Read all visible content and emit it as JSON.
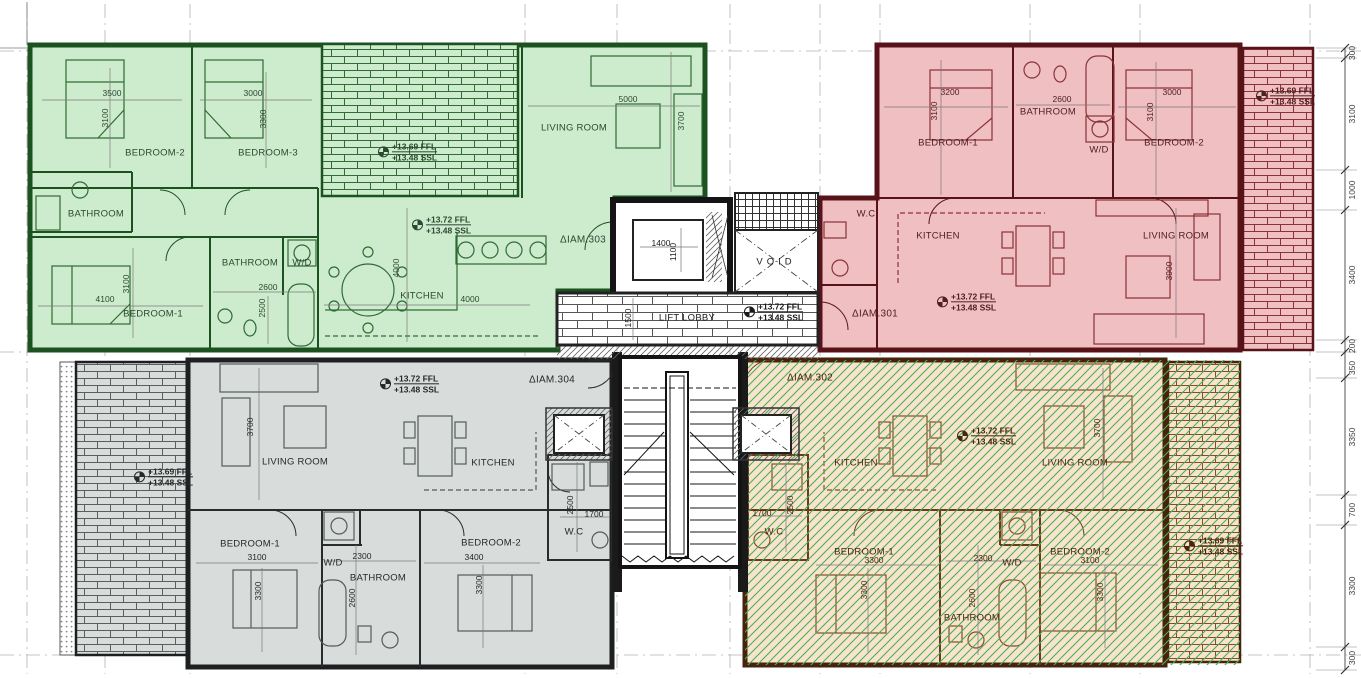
{
  "core": {
    "lift": {
      "width": "1400",
      "depth": "1100"
    },
    "void_label": "VOID",
    "lobby_label": "LIFT LOBBY",
    "lobby_depth": "1500",
    "level": {
      "ffl": "+13.72 FFL",
      "ssl": "+13.48 SSL"
    }
  },
  "apartments": {
    "apt303": {
      "id": "ΔIAM.303",
      "level": {
        "ffl": "+13.72 FFL",
        "ssl": "+13.48 SSL"
      },
      "balcony_level": {
        "ffl": "+13.69 FFL",
        "ssl": "+13.48 SSL"
      },
      "rooms": {
        "bedroom2": {
          "label": "BEDROOM-2",
          "w": "3500",
          "h": "3100"
        },
        "bedroom3": {
          "label": "BEDROOM-3",
          "w": "3000",
          "h": "3300"
        },
        "bathroom_top": {
          "label": "BATHROOM"
        },
        "living": {
          "label": "LIVING ROOM",
          "w": "5000",
          "h": "3700"
        },
        "kitchen": {
          "label": "KITCHEN",
          "w": "4000",
          "h": "4000"
        },
        "bedroom1": {
          "label": "BEDROOM-1",
          "w": "4100",
          "h": "3100"
        },
        "bathroom": {
          "label": "BATHROOM",
          "w": "2600",
          "h": "2500"
        },
        "wd": {
          "label": "W/D"
        }
      }
    },
    "apt301": {
      "id": "ΔIAM.301",
      "level": {
        "ffl": "+13.72 FFL",
        "ssl": "+13.48 SSL"
      },
      "balcony_level": {
        "ffl": "+13.69 FFL",
        "ssl": "+13.48 SSL"
      },
      "rooms": {
        "bedroom1": {
          "label": "BEDROOM-1",
          "w": "3200",
          "h": "3100"
        },
        "bathroom": {
          "label": "BATHROOM",
          "w": "2600"
        },
        "wd": {
          "label": "W/D"
        },
        "bedroom2": {
          "label": "BEDROOM-2",
          "w": "3000",
          "h": "3100"
        },
        "wc": {
          "label": "W.C"
        },
        "kitchen": {
          "label": "KITCHEN"
        },
        "living": {
          "label": "LIVING ROOM",
          "h": "3900"
        }
      }
    },
    "apt304": {
      "id": "ΔIAM.304",
      "level": {
        "ffl": "+13.72 FFL",
        "ssl": "+13.48 SSL"
      },
      "balcony_level": {
        "ffl": "+13.69 FFL",
        "ssl": "+13.48 SSL"
      },
      "rooms": {
        "living": {
          "label": "LIVING ROOM",
          "h": "3700"
        },
        "kitchen": {
          "label": "KITCHEN"
        },
        "wc": {
          "label": "W.C",
          "w": "1700",
          "h": "2500"
        },
        "bedroom1": {
          "label": "BEDROOM-1",
          "w": "3100",
          "h": "3300"
        },
        "wd": {
          "label": "W/D",
          "w": "2300"
        },
        "bathroom": {
          "label": "BATHROOM",
          "h": "2600"
        },
        "bedroom2": {
          "label": "BEDROOM-2",
          "w": "3400",
          "h": "3300"
        }
      }
    },
    "apt302": {
      "id": "ΔIAM.302",
      "level": {
        "ffl": "+13.72 FFL",
        "ssl": "+13.48 SSL"
      },
      "balcony_level": {
        "ffl": "+13.69 FFL",
        "ssl": "+13.48 SSL"
      },
      "rooms": {
        "kitchen": {
          "label": "KITCHEN"
        },
        "living": {
          "label": "LIVING ROOM",
          "h": "3700"
        },
        "wc": {
          "label": "W.C",
          "w": "1700",
          "h": "2500"
        },
        "bedroom1": {
          "label": "BEDROOM-1",
          "w": "3300",
          "h": "3300"
        },
        "wd": {
          "label": "W/D",
          "w": "2300"
        },
        "bathroom": {
          "label": "BATHROOM",
          "h": "2600"
        },
        "bedroom2": {
          "label": "BEDROOM-2",
          "w": "3100",
          "h": "3300"
        }
      }
    }
  },
  "dimensions": {
    "right_chain": [
      "300",
      "3100",
      "1000",
      "3400",
      "200",
      "350",
      "3350",
      "700",
      "3300",
      "300"
    ]
  },
  "colors": {
    "apt303_fill": "#cdeccd",
    "apt303_wall": "#1b5220",
    "apt303_text": "#2e4733",
    "apt301_fill": "#f0bfc2",
    "apt301_wall": "#571318",
    "apt301_text": "#4d2024",
    "apt304_fill": "#d8dddc",
    "apt304_wall": "#1d1f20",
    "apt304_text": "#26282a",
    "apt302_fill": "#fae2d1",
    "apt302_wall": "#47220e",
    "apt302_text": "#47260f",
    "apt302_hatch": "#43b54a",
    "grid": "#b3b3b3",
    "dim": "#3c3c3c"
  }
}
